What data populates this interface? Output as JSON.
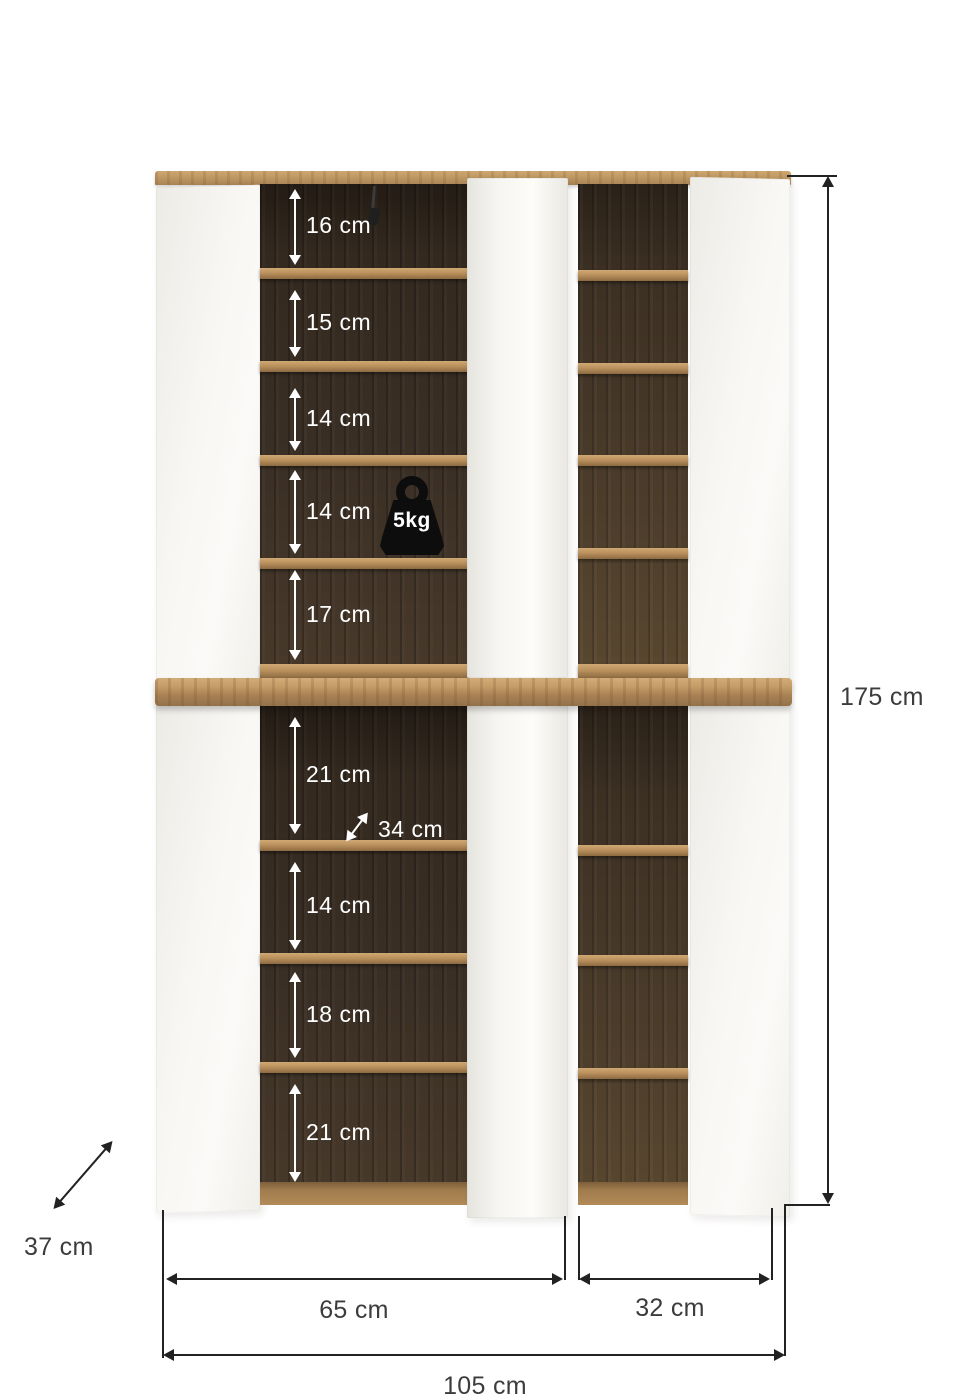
{
  "diagram": {
    "type": "furniture-dimension-diagram",
    "subject": "two-section shoe cabinet with open doors, oak interior and white fronts",
    "interior_labels_top": [
      {
        "label": "16 cm"
      },
      {
        "label": "15 cm"
      },
      {
        "label": "14 cm"
      },
      {
        "label": "14 cm"
      },
      {
        "label": "17 cm"
      }
    ],
    "interior_labels_bottom": [
      {
        "label": "21 cm"
      },
      {
        "label": "14 cm"
      },
      {
        "label": "18 cm"
      },
      {
        "label": "21 cm"
      }
    ],
    "diagonal_shelf_label": "34 cm",
    "max_load_label": "5kg",
    "overall": {
      "height_label": "175 cm",
      "depth_label": "37 cm",
      "left_section_width_label": "65 cm",
      "right_section_width_label": "32 cm",
      "total_width_label": "105 cm"
    },
    "icons": {
      "weight_icon": "kettlebell-weight-icon"
    },
    "colors": {
      "background": "#ffffff",
      "oak": "#b18a58",
      "dark_interior": "#342b22",
      "door_white": "#f7f6f3",
      "dimension_line": "#222222",
      "dimension_text": "#3c3c3c",
      "interior_annotation_text": "#ffffff",
      "badge_background": "#0d0d0d"
    }
  }
}
